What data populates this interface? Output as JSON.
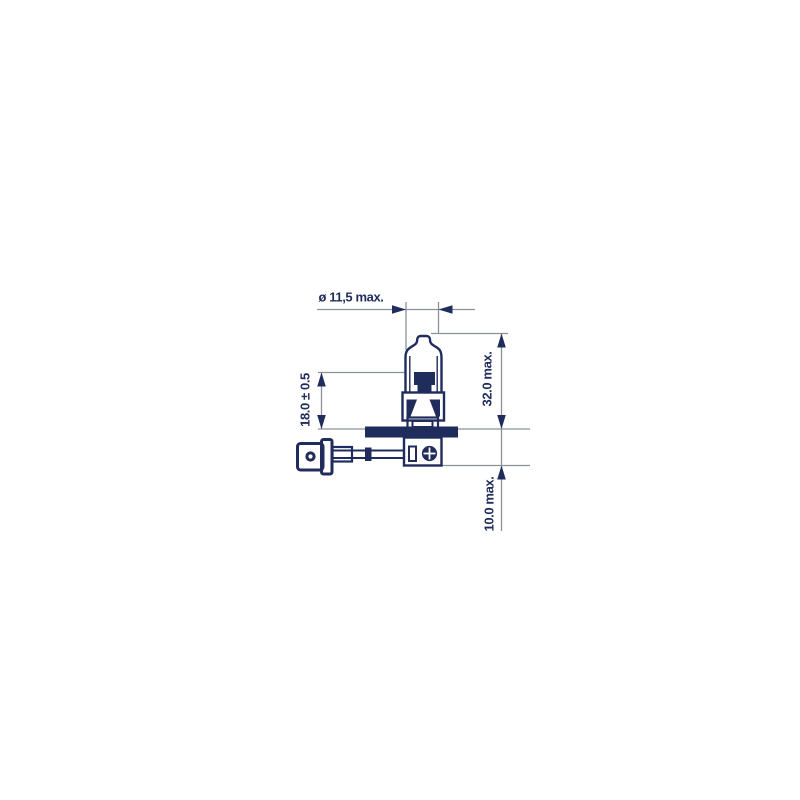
{
  "colors": {
    "ink": "#1f2c5c",
    "dim": "#8d9298",
    "background": "#ffffff"
  },
  "drawing": {
    "subject": "halogen-bulb-dimension-drawing",
    "dimensions": {
      "bulb_diameter": {
        "label": "ø 11,5 max."
      },
      "light_center_length": {
        "label": "18.0 ± 0.5"
      },
      "overall_length": {
        "label": "32.0 max."
      },
      "base_depth": {
        "label": "10.0 max."
      }
    }
  }
}
